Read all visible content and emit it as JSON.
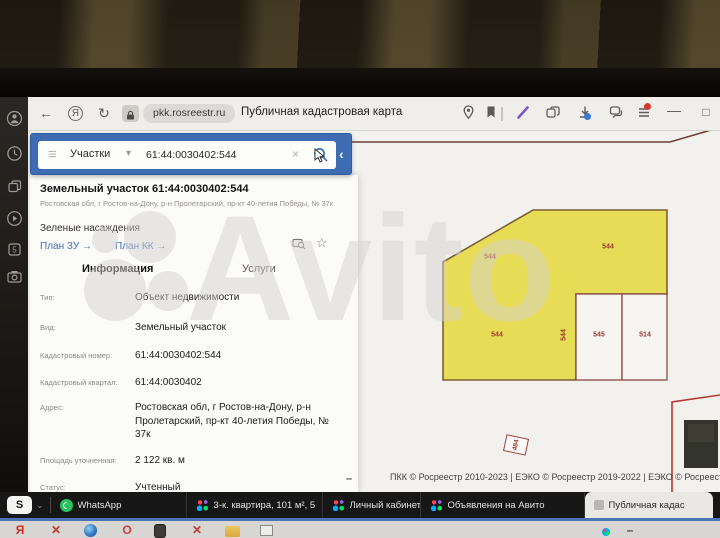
{
  "browser": {
    "url": "pkk.rosreestr.ru",
    "page_title": "Публичная кадастровая карта",
    "icons": {
      "back": "←",
      "yandex_badge": "Я",
      "refresh": "↻",
      "minimize": "—",
      "maximize": "□"
    }
  },
  "search": {
    "category": "Участки",
    "query": "61:44:0030402:544",
    "icons": {
      "menu": "≡",
      "chevron_down": "▾",
      "clear": "×",
      "collapse": "‹"
    }
  },
  "panel": {
    "title": "Земельный участок 61:44:0030402:544",
    "address_short": "Ростовская обл, г Ростов-на-Дону, р-н Пролетарский, пр-кт 40-летия Победы, № 37к",
    "category": "Зеленые насаждения",
    "links": [
      {
        "label": "План ЗУ →",
        "x": 10
      },
      {
        "label": "План КК →",
        "x": 85
      }
    ],
    "star_icon": "☆",
    "tabs": [
      {
        "label": "Информация",
        "x": 52,
        "active": true
      },
      {
        "label": "Услуги",
        "x": 212
      }
    ],
    "fields": [
      {
        "label": "Тип:",
        "value": "Объект недвижимости",
        "y": 116
      },
      {
        "label": "Вид:",
        "value": "Земельный участок",
        "y": 146
      },
      {
        "label": "Кадастровый номер:",
        "value": "61:44:0030402:544",
        "y": 174
      },
      {
        "label": "Кадастровый квартал:",
        "value": "61:44:0030402",
        "y": 201
      },
      {
        "label": "Адрес:",
        "value": "Ростовская обл, г Ростов-на-Дону, р-н Пролетарский, пр-кт 40-летия Победы, № 37к",
        "y": 226
      },
      {
        "label": "Площадь уточненная:",
        "value": "2 122 кв. м",
        "y": 279
      },
      {
        "label": "Статус:",
        "value": "Учтенный",
        "y": 306
      }
    ],
    "resize_dash": "–"
  },
  "map": {
    "parcel_labels": [
      {
        "text": "544",
        "x": 462,
        "y": 126
      },
      {
        "text": "544",
        "x": 580,
        "y": 116
      },
      {
        "text": "544",
        "x": 469,
        "y": 204
      },
      {
        "text": "544",
        "x": 536,
        "y": 204,
        "rot": -90
      },
      {
        "text": "545",
        "x": 571,
        "y": 204
      },
      {
        "text": "514",
        "x": 617,
        "y": 204
      },
      {
        "text": "484",
        "x": 488,
        "y": 314,
        "rot": -78,
        "kind": "boxed"
      }
    ],
    "attribution": "ПКК © Росреестр 2010-2023 | ЕЭКО © Росреестр 2019-2022 | ЕЭКО © Росреестр 201",
    "colors": {
      "parcel_fill": "#e7dc55",
      "parcel_border": "#7d5f35",
      "cutout_border": "#8a4a3f",
      "boundary_red": "#b5372c",
      "label": "#a03a2e"
    }
  },
  "watermark": {
    "text": "Avito"
  },
  "tabbar": {
    "pinned_label": "S",
    "pinned_chevron": "⌄",
    "tabs": [
      {
        "icon": "whatsapp",
        "label": "WhatsApp",
        "w": 136
      },
      {
        "icon": "avito",
        "label": "3-к. квартира, 101 м², 5",
        "w": 136
      },
      {
        "icon": "avito",
        "label": "Личный кабинет - Мо",
        "w": 98
      },
      {
        "icon": "avito",
        "label": "Объявления на Авито",
        "w": 164
      },
      {
        "icon": "pkk",
        "label": "Публичная кадас",
        "w": 128,
        "active": true
      }
    ]
  },
  "desktop": {
    "icons": [
      {
        "kind": "yandex",
        "glyph": "Я",
        "x": 12
      },
      {
        "kind": "close",
        "glyph": "✕",
        "x": 48
      },
      {
        "kind": "circle",
        "x": 84
      },
      {
        "kind": "opera",
        "glyph": "O",
        "x": 119
      },
      {
        "kind": "phone",
        "x": 154
      },
      {
        "kind": "close",
        "glyph": "✕",
        "x": 189
      },
      {
        "kind": "folder",
        "x": 225
      },
      {
        "kind": "image",
        "x": 260
      },
      {
        "kind": "mini",
        "x": 602
      },
      {
        "kind": "mini2",
        "glyph": "–",
        "x": 622
      }
    ]
  },
  "sidestrip": {
    "icon_names": [
      "user-icon",
      "clock-icon",
      "windows-icon",
      "play-icon",
      "five-icon",
      "camera-icon"
    ]
  }
}
